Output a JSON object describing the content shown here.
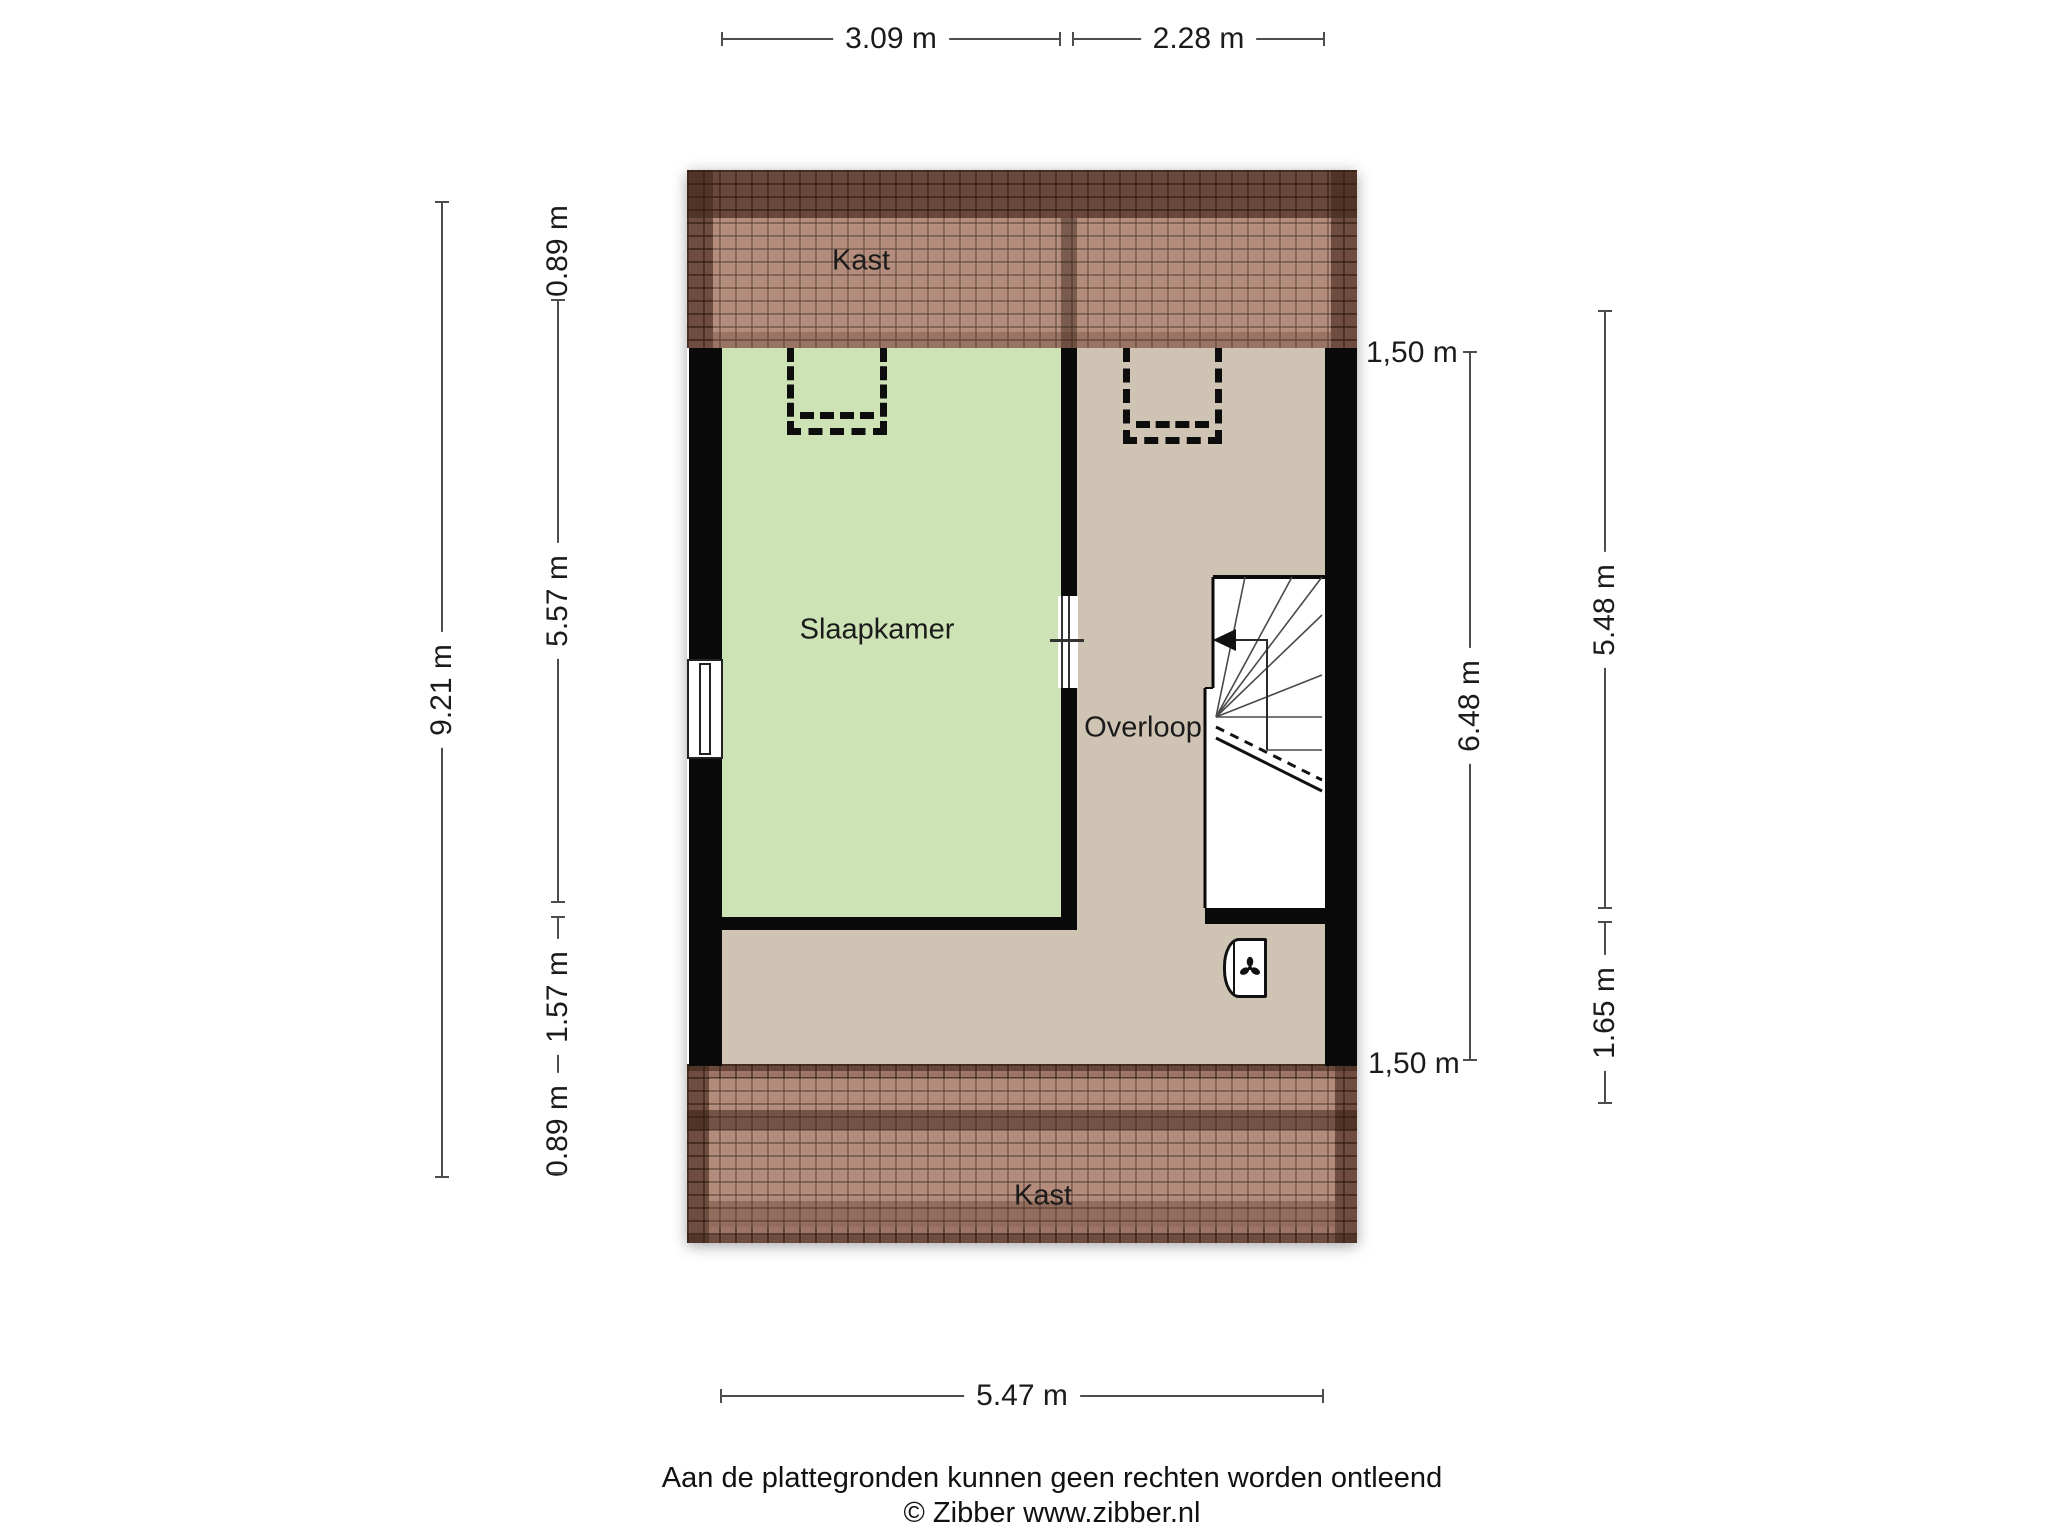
{
  "rooms": {
    "kast_top": {
      "label": "Kast"
    },
    "slaapkamer": {
      "label": "Slaapkamer"
    },
    "overloop": {
      "label": "Overloop"
    },
    "kast_bottom": {
      "label": "Kast"
    }
  },
  "dimensions": {
    "top": [
      {
        "label": "3.09 m"
      },
      {
        "label": "2.28 m"
      }
    ],
    "bottom": [
      {
        "label": "5.47 m"
      }
    ],
    "left_outer": [
      {
        "label": "9.21 m"
      }
    ],
    "left_inner": [
      {
        "label": "0.89 m"
      },
      {
        "label": "5.57 m"
      },
      {
        "label": "1.57 m"
      },
      {
        "label": "0.89 m"
      }
    ],
    "right_inner": {
      "top_label": "1,50 m",
      "line_label": "6.48 m",
      "bottom_label": "1,50 m"
    },
    "right_outer": [
      {
        "label": "5.48 m"
      },
      {
        "label": "1.65 m"
      }
    ]
  },
  "footer": {
    "line1": "Aan de plattegronden kunnen geen rechten worden ontleend",
    "line2": "© Zibber www.zibber.nl"
  },
  "icons": {
    "ventilation": "fan-icon",
    "stair_direction": "arrow-left-icon"
  },
  "colors": {
    "bedroom_fill": "#cde3b6",
    "landing_fill": "#cfc3b3",
    "roof_base": "#9e7466",
    "roof_dark": "#5e3f2e",
    "wall": "#0a0a0a",
    "dimension_line": "#4d4d4d",
    "text": "#1b1b1b"
  }
}
